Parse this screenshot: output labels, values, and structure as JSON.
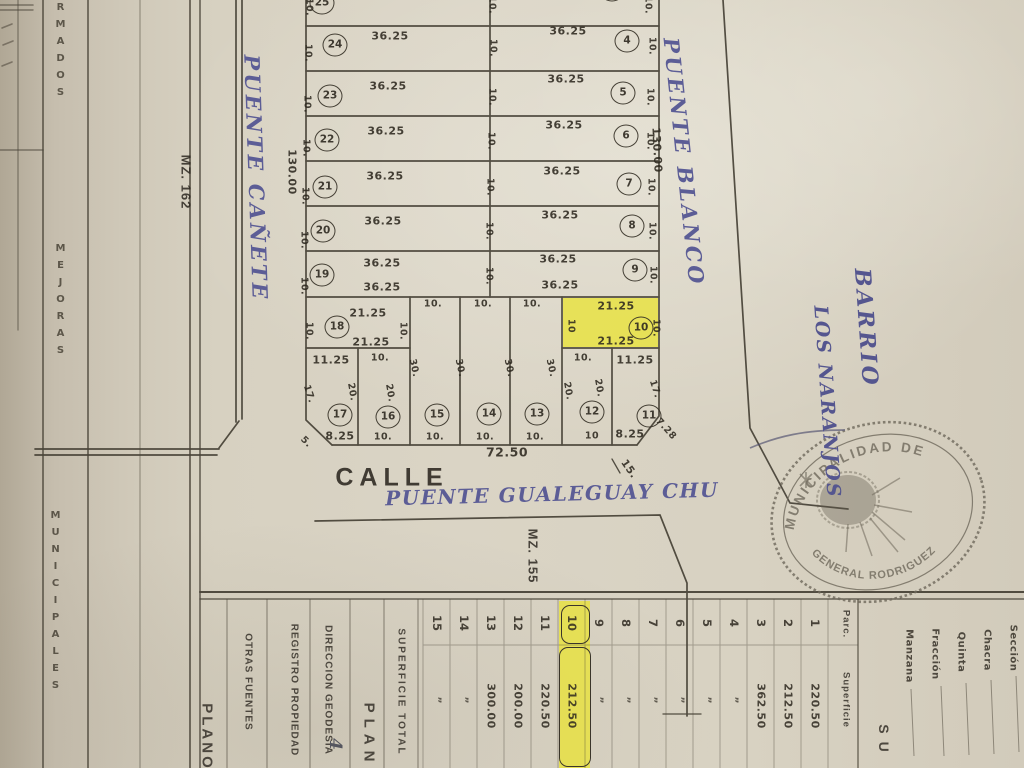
{
  "colors": {
    "paper": "#d6cfc0",
    "ink": "#3a352a",
    "handwriting": "#5c5d96",
    "highlight": "#e9e33a",
    "stamp": "#6f695c"
  },
  "margin": {
    "col_a": "RMADOS",
    "col_b": "MEJORAS",
    "col_c": "MUNICIPALES"
  },
  "map": {
    "calle": "CALLE",
    "street_hand": "PUENTE GUALEGUAY CHU",
    "street_west": "PUENTE  CAÑETE",
    "street_east": "PUENTE  BLANCO",
    "barrio_line1": "BARRIO",
    "barrio_line2": "LOS NARANJOS",
    "mz162": "MZ. 162",
    "mz155": "MZ. 155",
    "len_left": "130.00",
    "len_right": "130.00",
    "circles": [
      {
        "t": "25",
        "x": 322,
        "y": 3
      },
      {
        "t": "24",
        "x": 335,
        "y": 45
      },
      {
        "t": "23",
        "x": 330,
        "y": 96
      },
      {
        "t": "22",
        "x": 327,
        "y": 140
      },
      {
        "t": "21",
        "x": 325,
        "y": 187
      },
      {
        "t": "20",
        "x": 323,
        "y": 231
      },
      {
        "t": "19",
        "x": 322,
        "y": 275
      },
      {
        "t": "18",
        "x": 337,
        "y": 327
      },
      {
        "t": "3",
        "x": 612,
        "y": -10
      },
      {
        "t": "4",
        "x": 627,
        "y": 41
      },
      {
        "t": "5",
        "x": 623,
        "y": 93
      },
      {
        "t": "6",
        "x": 626,
        "y": 136
      },
      {
        "t": "7",
        "x": 629,
        "y": 184
      },
      {
        "t": "8",
        "x": 632,
        "y": 226
      },
      {
        "t": "9",
        "x": 635,
        "y": 270
      },
      {
        "t": "10",
        "x": 641,
        "y": 328
      },
      {
        "t": "17",
        "x": 340,
        "y": 415
      },
      {
        "t": "16",
        "x": 388,
        "y": 417
      },
      {
        "t": "15",
        "x": 437,
        "y": 415
      },
      {
        "t": "14",
        "x": 489,
        "y": 414
      },
      {
        "t": "13",
        "x": 537,
        "y": 414
      },
      {
        "t": "12",
        "x": 592,
        "y": 412
      },
      {
        "t": "11",
        "x": 649,
        "y": 416
      }
    ],
    "dims": [
      {
        "t": "10.",
        "x": 309,
        "y": 7,
        "r": 90
      },
      {
        "t": "10.",
        "x": 492,
        "y": 5,
        "r": 90
      },
      {
        "t": "10.",
        "x": 648,
        "y": 5,
        "r": 90
      },
      {
        "t": "36.25",
        "x": 390,
        "y": 36
      },
      {
        "t": "36.25",
        "x": 568,
        "y": 31
      },
      {
        "t": "10.",
        "x": 308,
        "y": 53,
        "r": 90
      },
      {
        "t": "10.",
        "x": 493,
        "y": 48,
        "r": 90
      },
      {
        "t": "10.",
        "x": 652,
        "y": 46,
        "r": 90
      },
      {
        "t": "36.25",
        "x": 388,
        "y": 86
      },
      {
        "t": "36.25",
        "x": 566,
        "y": 79
      },
      {
        "t": "10.",
        "x": 307,
        "y": 104,
        "r": 90
      },
      {
        "t": "10.",
        "x": 492,
        "y": 97,
        "r": 90
      },
      {
        "t": "10.",
        "x": 650,
        "y": 97,
        "r": 90
      },
      {
        "t": "36.25",
        "x": 386,
        "y": 131
      },
      {
        "t": "36.25",
        "x": 564,
        "y": 125
      },
      {
        "t": "10.",
        "x": 306,
        "y": 148,
        "r": 90
      },
      {
        "t": "10.",
        "x": 491,
        "y": 141,
        "r": 90
      },
      {
        "t": "10.",
        "x": 650,
        "y": 141,
        "r": 90
      },
      {
        "t": "36.25",
        "x": 385,
        "y": 176
      },
      {
        "t": "36.25",
        "x": 562,
        "y": 171
      },
      {
        "t": "10.",
        "x": 305,
        "y": 196,
        "r": 90
      },
      {
        "t": "10.",
        "x": 490,
        "y": 187,
        "r": 90
      },
      {
        "t": "10.",
        "x": 651,
        "y": 187,
        "r": 90
      },
      {
        "t": "36.25",
        "x": 383,
        "y": 221
      },
      {
        "t": "36.25",
        "x": 560,
        "y": 215
      },
      {
        "t": "10.",
        "x": 304,
        "y": 240,
        "r": 90
      },
      {
        "t": "10.",
        "x": 489,
        "y": 231,
        "r": 90
      },
      {
        "t": "10.",
        "x": 652,
        "y": 231,
        "r": 90
      },
      {
        "t": "36.25",
        "x": 382,
        "y": 263
      },
      {
        "t": "36.25",
        "x": 558,
        "y": 259
      },
      {
        "t": "36.25",
        "x": 382,
        "y": 287
      },
      {
        "t": "36.25",
        "x": 560,
        "y": 285
      },
      {
        "t": "10.",
        "x": 304,
        "y": 286,
        "r": 90
      },
      {
        "t": "10.",
        "x": 489,
        "y": 276,
        "r": 90
      },
      {
        "t": "10.",
        "x": 653,
        "y": 275,
        "r": 90
      },
      {
        "t": "21.25",
        "x": 368,
        "y": 313
      },
      {
        "t": "21.25",
        "x": 371,
        "y": 342
      },
      {
        "t": "10.",
        "x": 309,
        "y": 331,
        "r": 90
      },
      {
        "t": "10.",
        "x": 403,
        "y": 331,
        "r": 90
      },
      {
        "t": "10.",
        "x": 433,
        "y": 304
      },
      {
        "t": "10.",
        "x": 483,
        "y": 304
      },
      {
        "t": "10.",
        "x": 532,
        "y": 304
      },
      {
        "t": "21.25",
        "x": 616,
        "y": 306
      },
      {
        "t": "21.25",
        "x": 616,
        "y": 341
      },
      {
        "t": "10",
        "x": 571,
        "y": 326,
        "r": 90
      },
      {
        "t": "10.",
        "x": 656,
        "y": 328,
        "r": 90
      },
      {
        "t": "11.25",
        "x": 331,
        "y": 360
      },
      {
        "t": "17.",
        "x": 309,
        "y": 394,
        "r": 72
      },
      {
        "t": "20.",
        "x": 352,
        "y": 392,
        "r": 80
      },
      {
        "t": "8.25",
        "x": 340,
        "y": 436
      },
      {
        "t": "10.",
        "x": 380,
        "y": 358
      },
      {
        "t": "20.",
        "x": 390,
        "y": 393,
        "r": 80
      },
      {
        "t": "10.",
        "x": 383,
        "y": 437
      },
      {
        "t": "30.",
        "x": 414,
        "y": 368,
        "r": 78
      },
      {
        "t": "10.",
        "x": 435,
        "y": 437
      },
      {
        "t": "30.",
        "x": 460,
        "y": 368,
        "r": 78
      },
      {
        "t": "10.",
        "x": 485,
        "y": 437
      },
      {
        "t": "30.",
        "x": 509,
        "y": 368,
        "r": 78
      },
      {
        "t": "10.",
        "x": 535,
        "y": 437
      },
      {
        "t": "30.",
        "x": 551,
        "y": 368,
        "r": 78
      },
      {
        "t": "10.",
        "x": 583,
        "y": 358
      },
      {
        "t": "20.",
        "x": 568,
        "y": 391,
        "r": 80
      },
      {
        "t": "20.",
        "x": 599,
        "y": 388,
        "r": 80
      },
      {
        "t": "10",
        "x": 592,
        "y": 436
      },
      {
        "t": "11.25",
        "x": 635,
        "y": 360
      },
      {
        "t": "17.",
        "x": 655,
        "y": 389,
        "r": 72
      },
      {
        "t": "8.25",
        "x": 630,
        "y": 434
      },
      {
        "t": "7.28",
        "x": 666,
        "y": 429,
        "r": 48,
        "s": 9.5
      },
      {
        "t": "5.",
        "x": 306,
        "y": 442,
        "r": 45,
        "s": 9.5
      },
      {
        "t": "72.50",
        "x": 507,
        "y": 452,
        "s": 12.5
      },
      {
        "t": "15.",
        "x": 629,
        "y": 469,
        "r": 55,
        "s": 10.5
      }
    ]
  },
  "stamp": {
    "arc_top": "MUNICIPALIDAD DE",
    "arc_bottom": "GENERAL RODRIGUEZ"
  },
  "form": {
    "plano": "PLANO",
    "otras": "OTRAS FUENTES",
    "registro": "REGISTRO PROPIEDAD",
    "geodesia": "DIRECCION GEODESIA",
    "hand_note": "4",
    "plan": "PLAN",
    "sup_total": "SUPERFICIE TOTAL",
    "su": "SU",
    "fields": [
      "Sección",
      "Chacra",
      "Quinta",
      "Fracción",
      "Manzana"
    ],
    "table": {
      "parc_h": "Parc.",
      "sup_h": "Superficie",
      "rows": [
        [
          "1",
          "220.50",
          false
        ],
        [
          "2",
          "212.50",
          false
        ],
        [
          "3",
          "362.50",
          false
        ],
        [
          "4",
          "”",
          false
        ],
        [
          "5",
          "”",
          false
        ],
        [
          "6",
          "”",
          false
        ],
        [
          "7",
          "”",
          false
        ],
        [
          "8",
          "”",
          false
        ],
        [
          "9",
          "”",
          false
        ],
        [
          "10",
          "212.50",
          true
        ],
        [
          "11",
          "220.50",
          false
        ],
        [
          "12",
          "200.00",
          false
        ],
        [
          "13",
          "300.00",
          false
        ],
        [
          "14",
          "”",
          false
        ],
        [
          "15",
          "”",
          false
        ]
      ]
    }
  }
}
